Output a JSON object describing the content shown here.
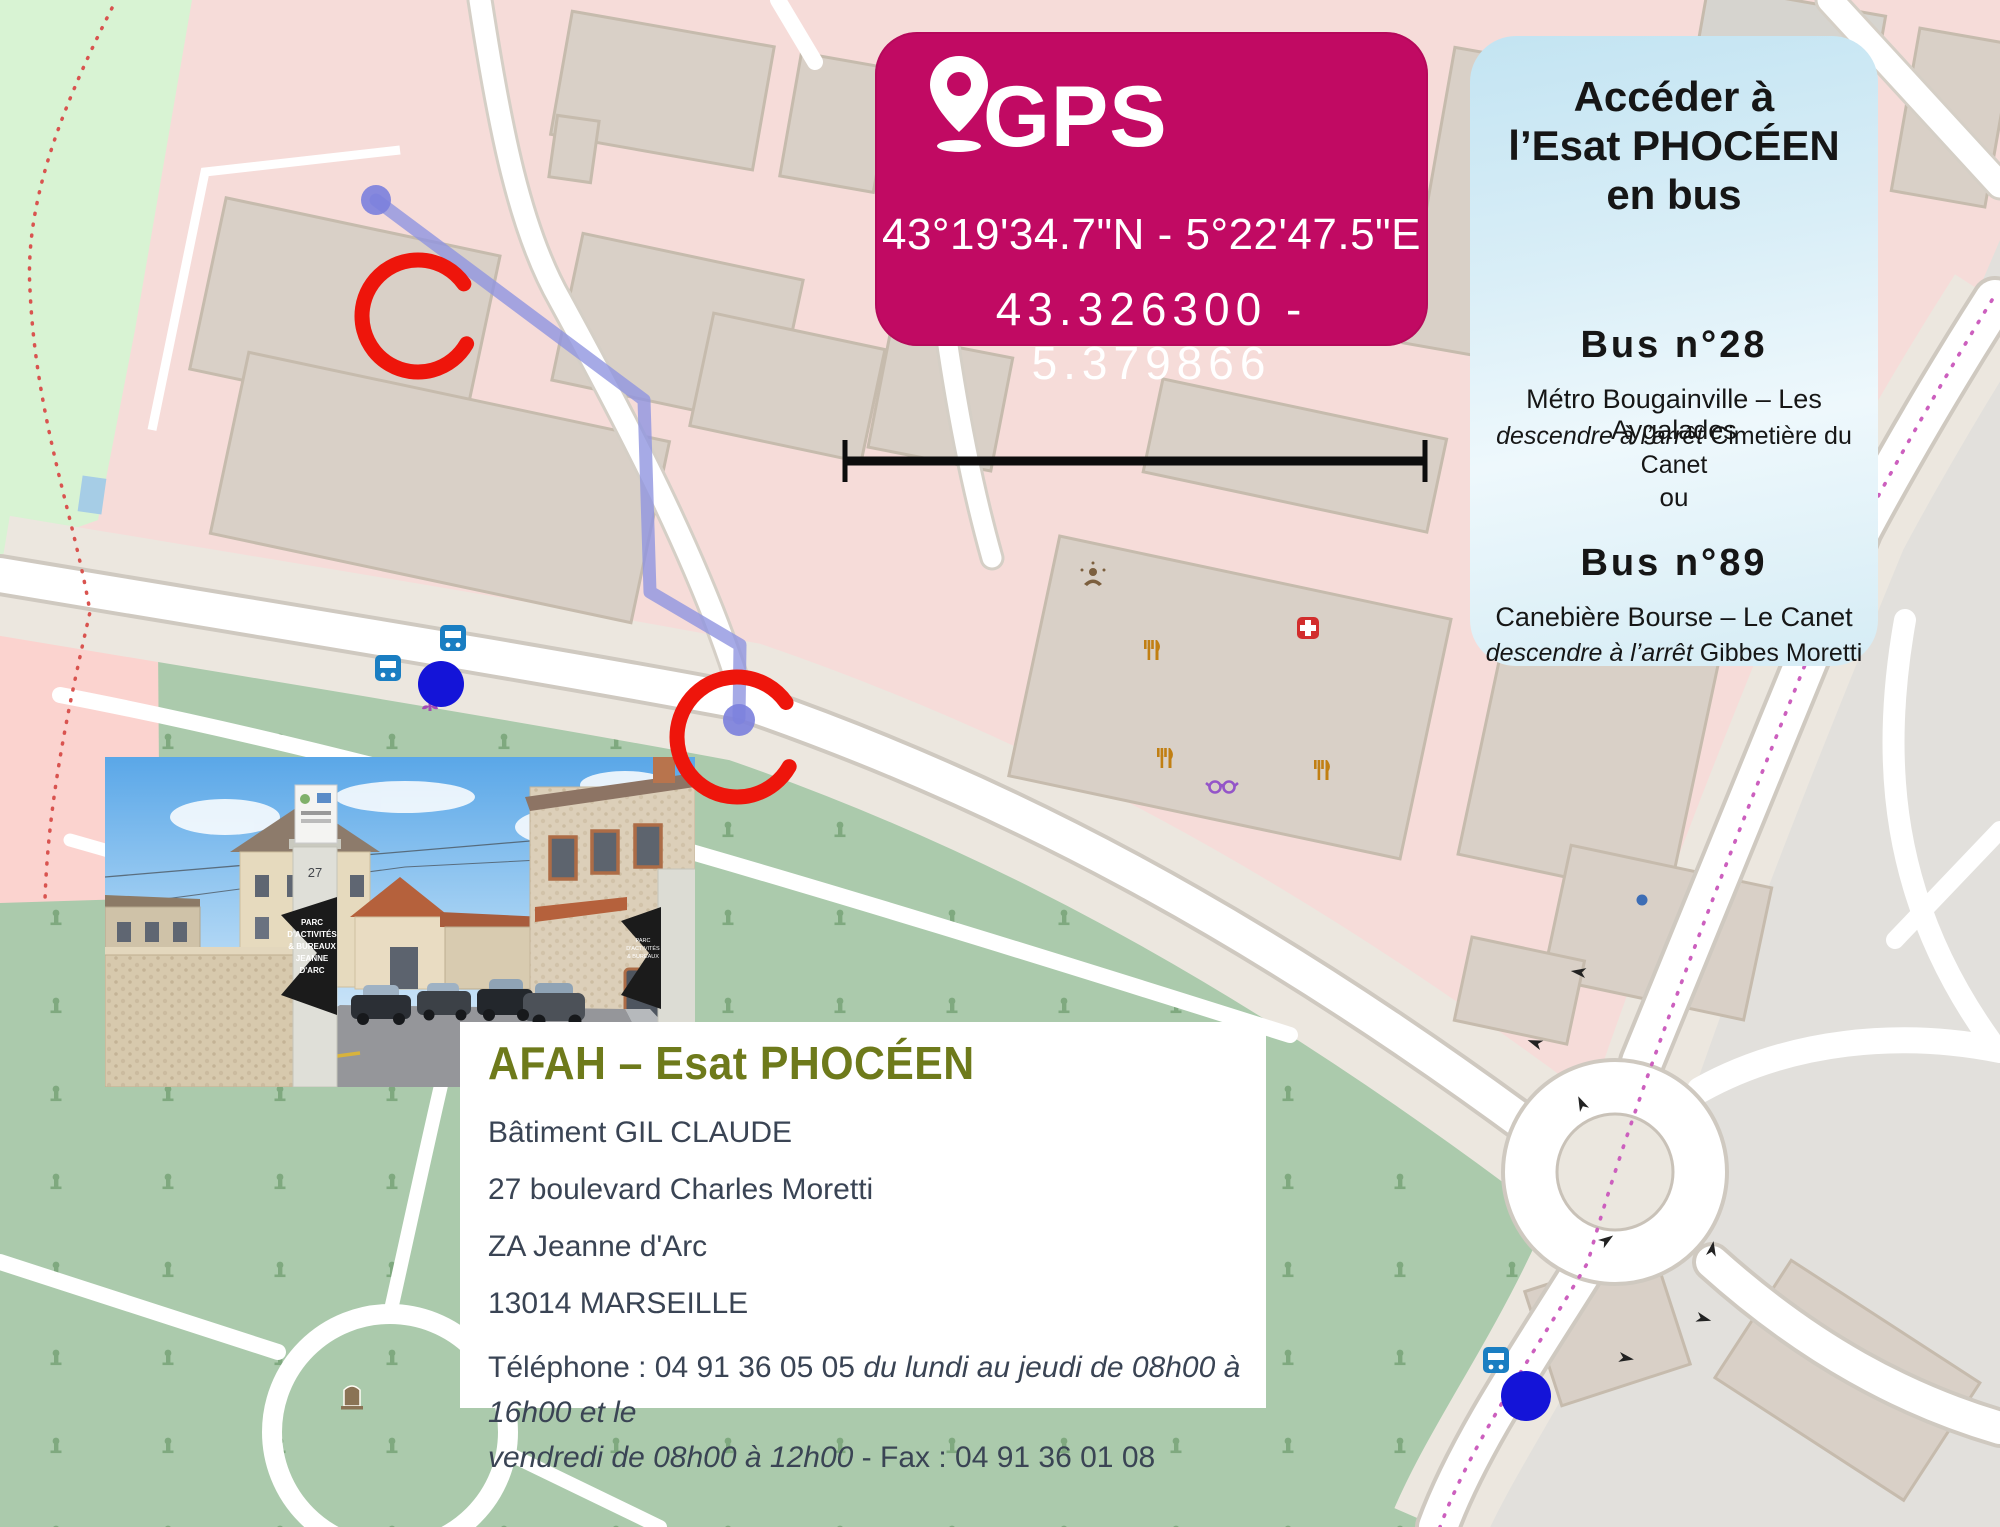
{
  "colors": {
    "accent_pink": "#c10a63",
    "bus_card_blue": "#cfe8f3",
    "annotation_blue": "#1616dc",
    "marker_red": "#ee150b",
    "route_purple": "#9095e0",
    "transit_label_blue": "#3d74c4",
    "poi_orange": "#c17f13",
    "cemetery_green": "#abcaac",
    "park_green": "#d8f3d3",
    "residential_pink": "#f6dcd9",
    "building_tan": "#d9d0c7",
    "bus_route_magenta": "#cc5fbe"
  },
  "gps_card": {
    "title": "GPS",
    "coords_dms": "43°19'34.7\"N - 5°22'47.5\"E",
    "coords_decimal": "43.326300 - 5.379866"
  },
  "bus_card": {
    "title_l1": "Accéder à",
    "title_l2": "l’Esat PHOCÉEN",
    "title_l3": "en bus",
    "bus1_name": "Bus n°28",
    "bus1_route": "Métro Bougainville – Les Aygalades",
    "bus1_stop_prefix": "descendre à l’arrêt ",
    "bus1_stop": "Cimetière du Canet",
    "or": "ou",
    "bus2_name": "Bus n°89",
    "bus2_route": "Canebière Bourse – Le Canet",
    "bus2_stop_prefix": "descendre à l’arrêt ",
    "bus2_stop": "Gibbes Moretti"
  },
  "info_card": {
    "title": "AFAH – Esat PHOCÉEN",
    "building": "Bâtiment GIL CLAUDE",
    "address": "27 boulevard Charles Moretti",
    "zone": "ZA Jeanne d'Arc",
    "city": "13014 MARSEILLE",
    "phone": "Téléphone : 04 91 36 05 05 ",
    "phone_hours": "du lundi au jeudi de 08h00 à 16h00 et le",
    "hours2": "vendredi de 08h00 à 12h00",
    "fax": " - Fax : 04 91 36 01 08"
  },
  "annotations": {
    "parking": "Parking",
    "entrance1_l1": "Entrée",
    "entrance1_l2": "ESAT Phocéen",
    "entrance2_l1": "Entrée",
    "entrance2_l2": "Zone Jeanne d'Arc",
    "station": "Station Alexandre",
    "bus28": "Bus n°28",
    "bus89": "Bus n°89"
  },
  "scale_bar": {
    "label": "100 m"
  },
  "streets": {
    "bd_moretti_nw": "Boulevard Charles Moretti",
    "bd_moretti_mid": "Boulevard Charles Moretti",
    "bd_moretti_se": "Boulevard Charles Moretti",
    "gibbes_large": "Chemin de Gibbes",
    "gibbes_upper": "Chemin de Gibbes",
    "gibbes_lower": "Chemin de Gibbes",
    "bon_secours": "Bon Secours",
    "le_canet": "Le Canet",
    "edge_fragment": "e t"
  },
  "map_pois": {
    "mission_l1": "Mission",
    "mission_l2": "Locale",
    "chaperons_l1": "Les Petits",
    "chaperons_l2": "Chaperons",
    "chaperons_l3": "Rouges",
    "barroco_l1": "Le New",
    "barroco_l2": "Barroco",
    "medical_l1": "Centre",
    "medical_l2": "Médical",
    "efl": "L'EFL Café",
    "optic": "Optic Avenue",
    "bistrot_l1": "Bistrot",
    "bistrot_l2": "Alexandre",
    "pole_l1": "Pôle emploi",
    "pole_l2": "Saint-Gabriel",
    "monument_l1": "Monument",
    "monument_l2": "aux morts",
    "venitien": "Le Vénitien",
    "parking_p": "P"
  },
  "bus_stops": {
    "stop_canet_l1": "Cimetière",
    "stop_canet_l2": "du Canet",
    "stop_canet2_l1": "Cimetière",
    "stop_canet2_l2": "du Canet",
    "stop_gibbes_l1": "Gibbes",
    "stop_gibbes_l2": "Moretti"
  },
  "house_numbers": {
    "n29": "29",
    "n31": "31"
  },
  "photo": {
    "gate_number": "27",
    "sign_l1": "PARC",
    "sign_l2": "D'ACTIVITÉS",
    "sign_l3": "& BUREAUX",
    "sign_l4": "JEANNE",
    "sign_l5": "D'ARC"
  }
}
